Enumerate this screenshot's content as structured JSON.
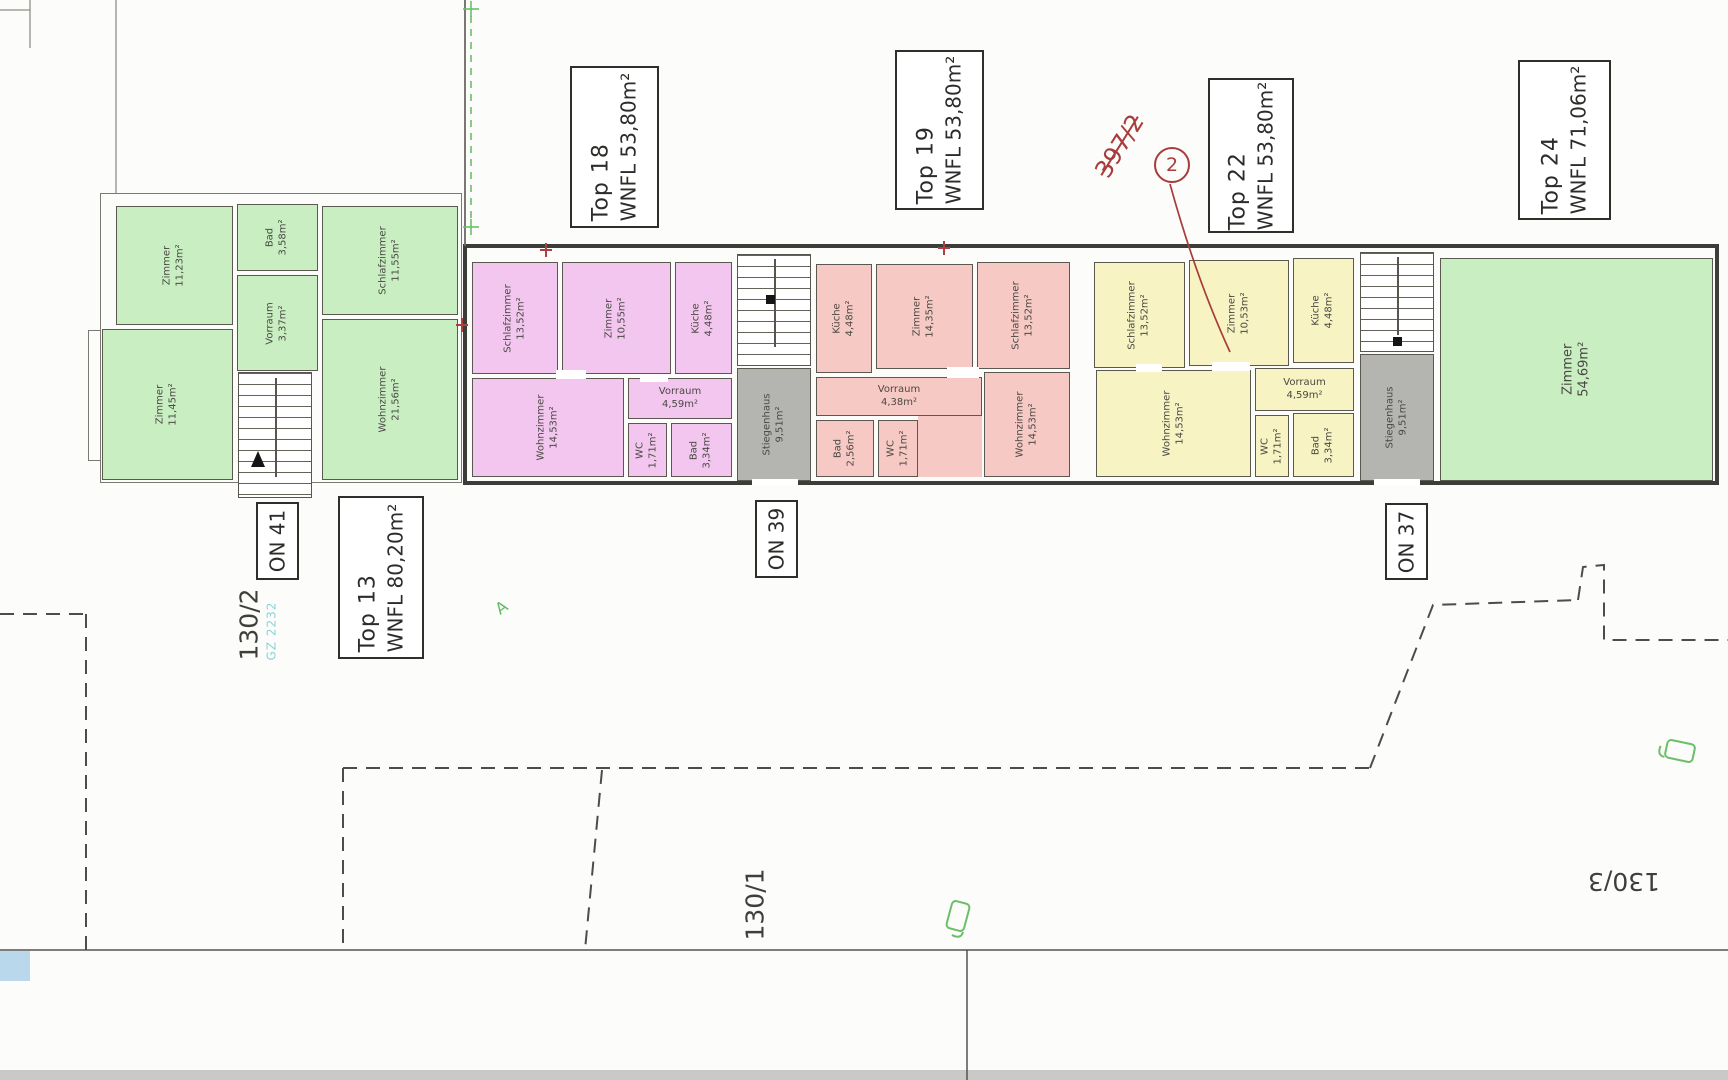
{
  "palette": {
    "unit_green": "#c9eec2",
    "unit_pink": "#f2c6ee",
    "unit_red": "#f7c9c4",
    "unit_yellow": "#f7f3c2",
    "stairwell_gray": "#b4b4b1",
    "wall": "#3c3c39",
    "annotation_red": "#a83c3c",
    "annotation_green": "#63ba61",
    "annotation_teal": "#8ad2d6"
  },
  "units": [
    {
      "id": "top13",
      "name": "Top 13",
      "wnfl": "WNFL 80,20m²"
    },
    {
      "id": "top18",
      "name": "Top 18",
      "wnfl": "WNFL 53,80m²"
    },
    {
      "id": "top19",
      "name": "Top 19",
      "wnfl": "WNFL 53,80m²"
    },
    {
      "id": "top22",
      "name": "Top 22",
      "wnfl": "WNFL 53,80m²"
    },
    {
      "id": "top24",
      "name": "Top 24",
      "wnfl": "WNFL 71,06m²"
    }
  ],
  "entrances": [
    {
      "id": "on41",
      "text": "ON 41"
    },
    {
      "id": "on39",
      "text": "ON 39"
    },
    {
      "id": "on37",
      "text": "ON 37"
    }
  ],
  "parcels": [
    {
      "id": "p130_2",
      "text": "130/2"
    },
    {
      "id": "p130_1",
      "text": "130/1"
    },
    {
      "id": "p130_3",
      "text": "130/3"
    },
    {
      "id": "p397_2",
      "text": "397/2",
      "struck": true
    }
  ],
  "annotations": {
    "revision_circle": "2",
    "survey_ref": "GZ 2232",
    "marker_letter": "A"
  },
  "rooms": [
    {
      "id": "lb_zimmer1",
      "unit": "top13",
      "name": "Zimmer",
      "area": "11,23m²",
      "color": "green",
      "orient": "v"
    },
    {
      "id": "lb_bad",
      "unit": "top13",
      "name": "Bad",
      "area": "3,58m²",
      "color": "green",
      "orient": "v"
    },
    {
      "id": "lb_schlaf",
      "unit": "top13",
      "name": "Schlafzimmer",
      "area": "11,55m²",
      "color": "green",
      "orient": "v"
    },
    {
      "id": "lb_vorraum",
      "unit": "top13",
      "name": "Vorraum",
      "area": "3,37m²",
      "color": "green",
      "orient": "v"
    },
    {
      "id": "lb_zimmer2",
      "unit": "top13",
      "name": "Zimmer",
      "area": "11,45m²",
      "color": "green",
      "orient": "v"
    },
    {
      "id": "lb_wohn",
      "unit": "top13",
      "name": "Wohnzimmer",
      "area": "21,56m²",
      "color": "green",
      "orient": "v"
    },
    {
      "id": "p_schlaf",
      "unit": "top18",
      "name": "Schlafzimmer",
      "area": "13,52m²",
      "color": "pink",
      "orient": "v"
    },
    {
      "id": "p_zimmer",
      "unit": "top18",
      "name": "Zimmer",
      "area": "10,55m²",
      "color": "pink",
      "orient": "v"
    },
    {
      "id": "p_kueche",
      "unit": "top18",
      "name": "Küche",
      "area": "4,48m²",
      "color": "pink",
      "orient": "v"
    },
    {
      "id": "p_wohn",
      "unit": "top18",
      "name": "Wohnzimmer",
      "area": "14,53m²",
      "color": "pink",
      "orient": "v"
    },
    {
      "id": "p_vorraum",
      "unit": "top18",
      "name": "Vorraum",
      "area": "4,59m²",
      "color": "pink",
      "orient": "h"
    },
    {
      "id": "p_wc",
      "unit": "top18",
      "name": "WC",
      "area": "1,71m²",
      "color": "pink",
      "orient": "v"
    },
    {
      "id": "p_bad",
      "unit": "top18",
      "name": "Bad",
      "area": "3,34m²",
      "color": "pink",
      "orient": "v"
    },
    {
      "id": "sg1",
      "unit": "",
      "name": "Stiegenhaus",
      "area": "9,51m²",
      "color": "gray",
      "orient": "v"
    },
    {
      "id": "r_kueche",
      "unit": "top19",
      "name": "Küche",
      "area": "4,48m²",
      "color": "red",
      "orient": "v"
    },
    {
      "id": "r_zimmer",
      "unit": "top19",
      "name": "Zimmer",
      "area": "14,35m²",
      "color": "red",
      "orient": "v"
    },
    {
      "id": "r_schlaf",
      "unit": "top19",
      "name": "Schlafzimmer",
      "area": "13,52m²",
      "color": "red",
      "orient": "v"
    },
    {
      "id": "r_vorraum",
      "unit": "top19",
      "name": "Vorraum",
      "area": "4,38m²",
      "color": "red",
      "orient": "h"
    },
    {
      "id": "r_bad",
      "unit": "top19",
      "name": "Bad",
      "area": "2,56m²",
      "color": "red",
      "orient": "v"
    },
    {
      "id": "r_wc",
      "unit": "top19",
      "name": "WC",
      "area": "1,71m²",
      "color": "red",
      "orient": "v"
    },
    {
      "id": "r_wohn",
      "unit": "top19",
      "name": "Wohnzimmer",
      "area": "14,53m²",
      "color": "red",
      "orient": "v"
    },
    {
      "id": "y_schlaf",
      "unit": "top22",
      "name": "Schlafzimmer",
      "area": "13,52m²",
      "color": "yellow",
      "orient": "v"
    },
    {
      "id": "y_zimmer",
      "unit": "top22",
      "name": "Zimmer",
      "area": "10,53m²",
      "color": "yellow",
      "orient": "v"
    },
    {
      "id": "y_kueche",
      "unit": "top22",
      "name": "Küche",
      "area": "4,48m²",
      "color": "yellow",
      "orient": "v"
    },
    {
      "id": "y_wohn",
      "unit": "top22",
      "name": "Wohnzimmer",
      "area": "14,53m²",
      "color": "yellow",
      "orient": "v"
    },
    {
      "id": "y_vorraum",
      "unit": "top22",
      "name": "Vorraum",
      "area": "4,59m²",
      "color": "yellow",
      "orient": "h"
    },
    {
      "id": "y_wc",
      "unit": "top22",
      "name": "WC",
      "area": "1,71m²",
      "color": "yellow",
      "orient": "v"
    },
    {
      "id": "y_bad",
      "unit": "top22",
      "name": "Bad",
      "area": "3,34m²",
      "color": "yellow",
      "orient": "v"
    },
    {
      "id": "sg2",
      "unit": "",
      "name": "Stiegenhaus",
      "area": "9,51m²",
      "color": "gray",
      "orient": "v"
    },
    {
      "id": "g_zimmer",
      "unit": "top24",
      "name": "Zimmer",
      "area": "54,69m²",
      "color": "green",
      "orient": "v",
      "big": true
    }
  ]
}
